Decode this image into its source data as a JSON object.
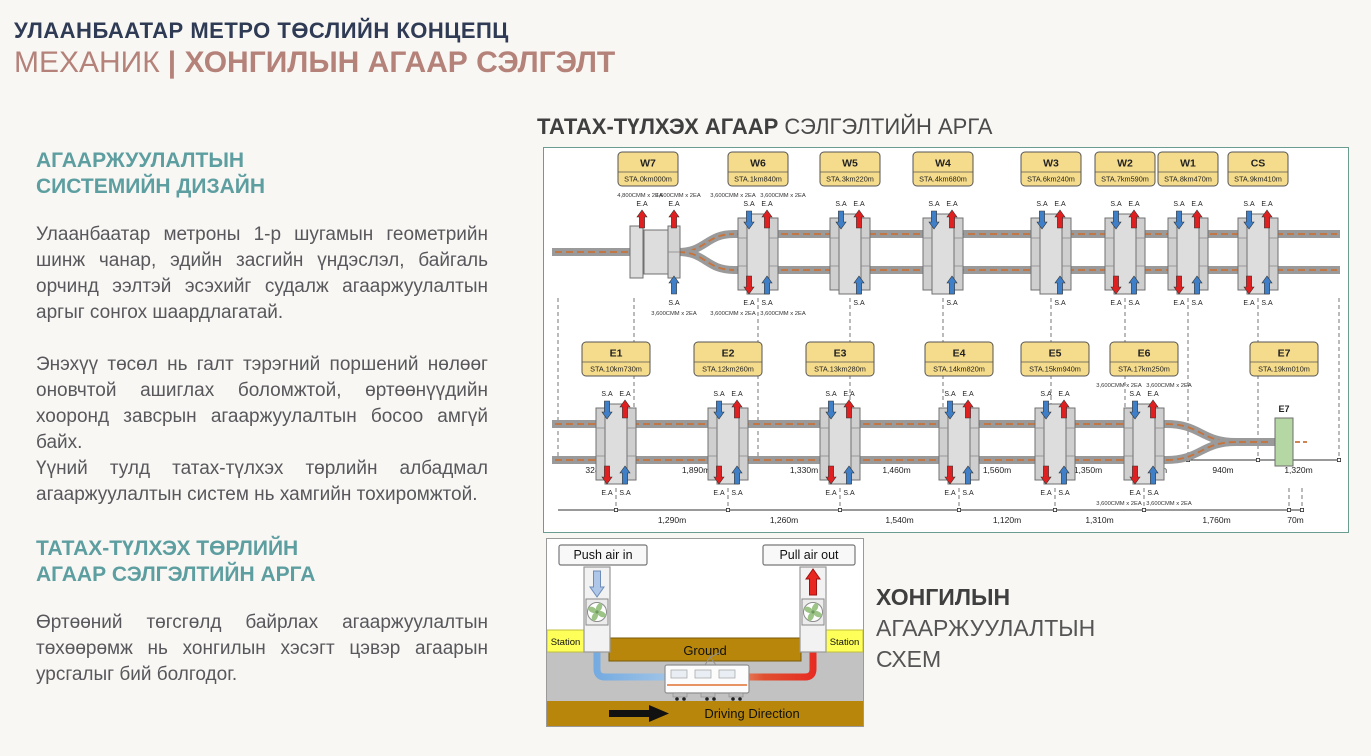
{
  "header": {
    "kicker": "УЛААНБААТАР МЕТРО ТӨСЛИЙН КОНЦЕПЦ",
    "headline_light": "МЕХАНИК",
    "headline_bold": "| ХОНГИЛЫН АГААР СЭЛГЭЛТ"
  },
  "left_column": {
    "section1": {
      "heading_line1": "АГААРЖУУЛАЛТЫН",
      "heading_line2": "СИСТЕМИЙН ДИЗАЙН",
      "para1": "Улаанбаатар метроны 1-р шугамын геометрийн шинж чанар, эдийн засгийн үндэслэл, байгаль орчинд ээлтэй эсэхийг судалж агааржуулалтын аргыг сонгох шаардлагатай.",
      "para2_line1": "Энэхүү төсөл нь галт тэрэгний поршений нөлөөг оновчтой ашиглах боломжтой, өртөөнүүдийн хооронд завсрын агааржуулалтын босоо амгүй байх.",
      "para2_line2": "Үүний тулд татах-түлхэх төрлийн албадмал агааржуулалтын систем нь хамгийн тохиромжтой."
    },
    "section2": {
      "heading_line1": "ТАТАХ-ТҮЛХЭХ ТӨРЛИЙН",
      "heading_line2": "АГААР СЭЛГЭЛТИЙН АРГА",
      "para": "Өртөөний төгсгөлд байрлах агааржуулалтын төхөөрөмж нь хонгилын хэсэгт цэвэр агаарын урсгалыг бий болгодог."
    }
  },
  "diagram": {
    "title_bold": "ТАТАХ-ТҮЛХЭХ АГААР",
    "title_regular": "СЭЛГЭЛТИЙН АРГА",
    "supply_label": "S.A",
    "exhaust_label": "E.A",
    "rows": [
      {
        "name": "west",
        "fork": "split",
        "ty": 4,
        "axis_y": 308,
        "dash_top": 146,
        "stations": [
          {
            "id": "W7",
            "sta": "STA.0km000m",
            "x": 104,
            "kind": "terminal",
            "top": [
              {
                "a": "EA",
                "cmm": "4,800CMM x 2EA"
              }
            ],
            "bot": []
          },
          {
            "id": "",
            "sta": "",
            "x": 130,
            "kind": "shaft",
            "top": [
              {
                "a": "EA",
                "cmm": "3,600CMM x 2EA"
              }
            ],
            "bot": [
              {
                "a": "SA",
                "cmm": "3,600CMM x 2EA"
              }
            ]
          },
          {
            "id": "W6",
            "sta": "STA.1km840m",
            "x": 214,
            "kind": "station",
            "top": [
              {
                "a": "SA",
                "cmm": "3,600CMM x 2EA"
              },
              {
                "a": "EA",
                "cmm": "3,600CMM x 2EA"
              }
            ],
            "bot": [
              {
                "a": "EA",
                "cmm": "3,600CMM x 2EA"
              },
              {
                "a": "SA",
                "cmm": "3,600CMM x 2EA"
              }
            ]
          },
          {
            "id": "W5",
            "sta": "STA.3km220m",
            "x": 306,
            "kind": "station",
            "top": [
              {
                "a": "SA"
              },
              {
                "a": "EA"
              }
            ],
            "bot": [
              {
                "a": "SA"
              }
            ]
          },
          {
            "id": "W4",
            "sta": "STA.4km680m",
            "x": 399,
            "kind": "station",
            "top": [
              {
                "a": "SA"
              },
              {
                "a": "EA"
              }
            ],
            "bot": [
              {
                "a": "SA"
              }
            ]
          },
          {
            "id": "W3",
            "sta": "STA.6km240m",
            "x": 507,
            "kind": "station",
            "top": [
              {
                "a": "SA"
              },
              {
                "a": "EA"
              }
            ],
            "bot": [
              {
                "a": "SA"
              }
            ]
          },
          {
            "id": "W2",
            "sta": "STA.7km590m",
            "x": 581,
            "kind": "station",
            "top": [
              {
                "a": "SA"
              },
              {
                "a": "EA"
              }
            ],
            "bot": [
              {
                "a": "EA"
              },
              {
                "a": "SA"
              }
            ]
          },
          {
            "id": "W1",
            "sta": "STA.8km470m",
            "x": 644,
            "kind": "station",
            "top": [
              {
                "a": "SA"
              },
              {
                "a": "EA"
              }
            ],
            "bot": [
              {
                "a": "EA"
              },
              {
                "a": "SA"
              }
            ]
          },
          {
            "id": "CS",
            "sta": "STA.9km410m",
            "x": 714,
            "kind": "station",
            "top": [
              {
                "a": "SA"
              },
              {
                "a": "EA"
              }
            ],
            "bot": [
              {
                "a": "EA"
              },
              {
                "a": "SA"
              }
            ]
          }
        ],
        "ticks": [
          14,
          90,
          214,
          306,
          399,
          507,
          581,
          644,
          714,
          795
        ],
        "distances": [
          "324m",
          "1,890m",
          "1,330m",
          "1,460m",
          "1,560m",
          "1,350m",
          "880m",
          "940m",
          "1,320m"
        ]
      },
      {
        "name": "east",
        "fork": "merge",
        "ty": 194,
        "axis_y": 168,
        "dash_top": 146,
        "stations": [
          {
            "id": "E1",
            "sta": "STA.10km730m",
            "x": 72,
            "kind": "station",
            "top": [
              {
                "a": "SA"
              },
              {
                "a": "EA"
              }
            ],
            "bot": [
              {
                "a": "EA"
              },
              {
                "a": "SA"
              }
            ]
          },
          {
            "id": "E2",
            "sta": "STA.12km260m",
            "x": 184,
            "kind": "station",
            "top": [
              {
                "a": "SA"
              },
              {
                "a": "EA"
              }
            ],
            "bot": [
              {
                "a": "EA"
              },
              {
                "a": "SA"
              }
            ]
          },
          {
            "id": "E3",
            "sta": "STA.13km280m",
            "x": 296,
            "kind": "station",
            "top": [
              {
                "a": "SA"
              },
              {
                "a": "EA"
              }
            ],
            "bot": [
              {
                "a": "EA"
              },
              {
                "a": "SA"
              }
            ]
          },
          {
            "id": "E4",
            "sta": "STA.14km820m",
            "x": 415,
            "kind": "station",
            "top": [
              {
                "a": "SA"
              },
              {
                "a": "EA"
              }
            ],
            "bot": [
              {
                "a": "EA"
              },
              {
                "a": "SA"
              }
            ]
          },
          {
            "id": "E5",
            "sta": "STA.15km940m",
            "x": 511,
            "kind": "station",
            "top": [
              {
                "a": "SA"
              },
              {
                "a": "EA"
              }
            ],
            "bot": [
              {
                "a": "EA"
              },
              {
                "a": "SA"
              }
            ]
          },
          {
            "id": "E6",
            "sta": "STA.17km250m",
            "x": 600,
            "kind": "station",
            "top": [
              {
                "a": "SA",
                "cmm": "3,600CMM x 2EA"
              },
              {
                "a": "EA",
                "cmm": "3,600CMM x 2EA"
              }
            ],
            "bot": [
              {
                "a": "EA",
                "cmm": "3,600CMM x 2EA"
              },
              {
                "a": "SA",
                "cmm": "3,600CMM x 2EA"
              }
            ]
          },
          {
            "id": "E7",
            "sta": "STA.19km010m",
            "x": 740,
            "kind": "green",
            "top": [],
            "bot": []
          }
        ],
        "ticks": [
          72,
          184,
          296,
          415,
          511,
          600,
          745,
          758
        ],
        "distances": [
          "1,290m",
          "1,260m",
          "1,540m",
          "1,120m",
          "1,310m",
          "1,760m",
          "70m"
        ]
      }
    ]
  },
  "scheme": {
    "push_label": "Push air in",
    "pull_label": "Pull air out",
    "station_label": "Station",
    "ground_label": "Ground",
    "driving_label": "Driving Direction",
    "caption_line1": "ХОНГИЛЫН",
    "caption_line2": "АГААРЖУУЛАЛТЫН",
    "caption_line3": "СХЕМ"
  },
  "colors": {
    "kicker_navy": "#2F3B55",
    "headline_rose": "#B5827A",
    "accent_teal": "#5D9EA0",
    "body_text": "#58585C",
    "panel_border": "#6B9C90",
    "station_box_fill": "#F5DC8C",
    "track_gray": "#9A9A9A",
    "dash_orange": "#C8733B",
    "supply_blue": "#3F7FC8",
    "exhaust_red": "#E02020",
    "e7_green": "#B5D7A3",
    "ground_gold": "#B8860B",
    "station_yellow": "#FFFF5A",
    "scheme_gray_band": "#C2C2C2"
  }
}
